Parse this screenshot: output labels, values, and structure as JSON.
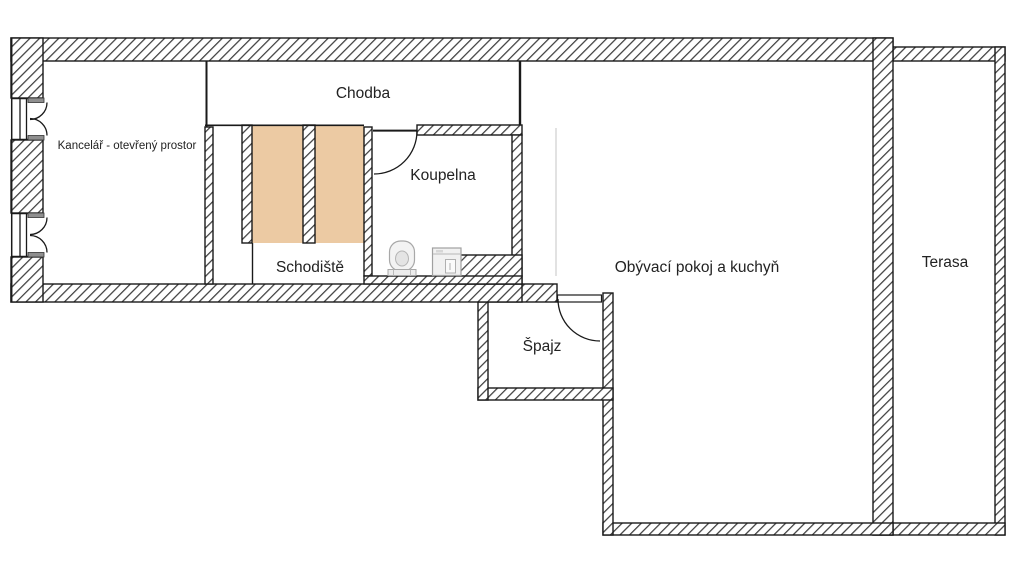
{
  "floorplan": {
    "rooms": {
      "kancelar": {
        "label": "Kancelář - otevřený prostor"
      },
      "chodba": {
        "label": "Chodba"
      },
      "koupelna": {
        "label": "Koupelna"
      },
      "schodiste": {
        "label": "Schodiště"
      },
      "obyvaci_pokoj": {
        "label": "Obývací pokoj a kuchyň"
      },
      "spajz": {
        "label": "Špajz"
      },
      "terasa": {
        "label": "Terasa"
      }
    },
    "colors": {
      "stairs_fill": "#eccaa3",
      "hatch_line": "#3f3f3f",
      "wall_outline": "#1a1a1a",
      "faint_line": "#e2e2e2",
      "fixture_fill": "#f1f1f1",
      "fixture_outline": "#a0a0a0"
    }
  }
}
